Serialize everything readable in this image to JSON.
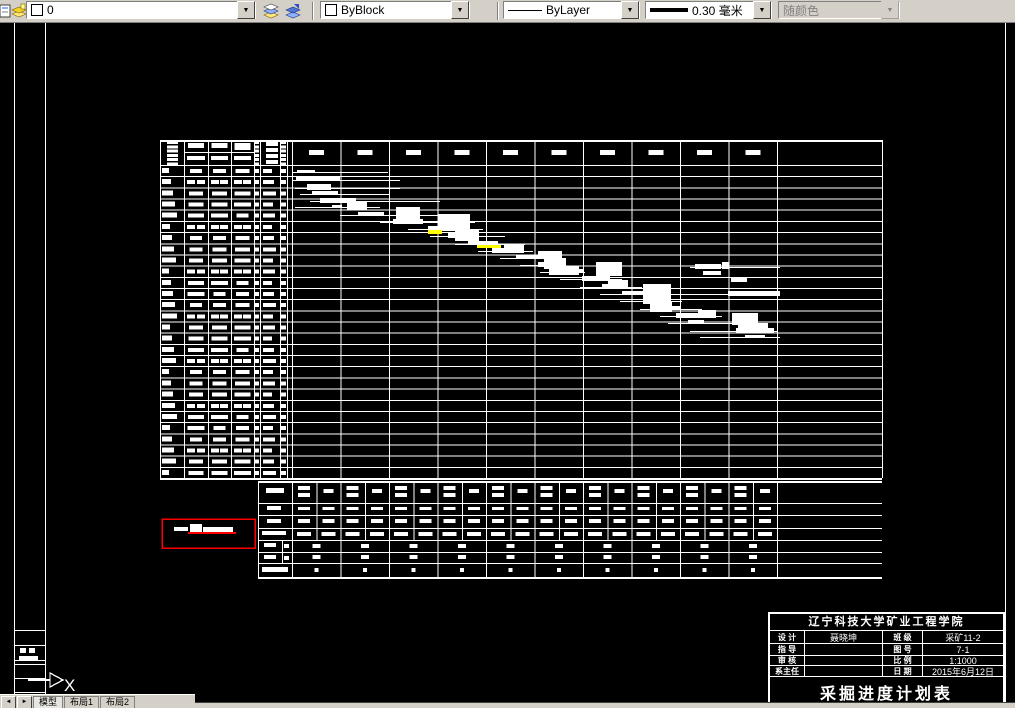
{
  "toolbar": {
    "layer": {
      "name": "0"
    },
    "color": {
      "value": "ByBlock"
    },
    "linetype": {
      "value": "ByLayer"
    },
    "lineweight": {
      "value": "0.30 毫米"
    },
    "plot_style": {
      "value": "随颜色"
    },
    "dropdown_arrow": "▼"
  },
  "tabs": {
    "nav_prev": "◄",
    "nav_next": "►",
    "items": [
      "模型",
      "布局1",
      "布局2"
    ]
  },
  "title_block": {
    "school": "辽宁科技大学矿业工程学院",
    "rows": [
      {
        "l1": "设 计",
        "v1": "聂晓坤",
        "l2": "班 级",
        "v2": "采矿11-2"
      },
      {
        "l1": "指 导",
        "v1": "",
        "l2": "图 号",
        "v2": "7-1"
      },
      {
        "l1": "审 核",
        "v1": "",
        "l2": "比 例",
        "v2": "1:1000"
      },
      {
        "l1": "系主任",
        "v1": "",
        "l2": "日 期",
        "v2": "2015年6月12日"
      }
    ],
    "title": "采掘进度计划表"
  },
  "ucs": {
    "label": "X"
  },
  "colors": {
    "white": "#ffffff",
    "yellow": "#ffff00",
    "red": "#ff0000",
    "toolbar_bg": "#d4d0c8"
  },
  "drawing": {
    "frame_vlines": [
      [
        14,
        22,
        703
      ],
      [
        45,
        22,
        703
      ],
      [
        1005,
        22,
        703
      ]
    ],
    "mini": {
      "x": 14,
      "w": 31,
      "hlines_y": [
        630,
        645,
        660,
        664,
        678,
        692
      ],
      "marks": [
        [
          20,
          648,
          6,
          5
        ],
        [
          29,
          648,
          6,
          5
        ],
        [
          19,
          656,
          19,
          5
        ]
      ]
    },
    "ucs_gfx": {
      "line": [
        28,
        679,
        50
      ],
      "arrow": "50,673 63,680 50,687"
    },
    "main": {
      "left": 160,
      "right": 882,
      "top": 140,
      "hdr": 165,
      "bottom": 478,
      "rows": 28,
      "rowH": 11.18,
      "cols": [
        160,
        184,
        208,
        231,
        254,
        260,
        280,
        287
      ],
      "gx": 292,
      "gw": 48.5,
      "gcols": 10,
      "hdrDash": [
        17,
        150,
        15,
        5
      ]
    },
    "sum": {
      "left": 258,
      "labelX": 292,
      "subX": 282,
      "top": 481,
      "bottom": 577,
      "right": 882,
      "halfW": 24.25,
      "halfCols": 20,
      "months": 10,
      "monthW": 48.5,
      "rowYs": [
        503,
        515,
        528,
        540,
        552,
        563
      ],
      "monthTop": 540
    },
    "bars": [
      [
        297,
        170,
        18,
        3
      ],
      [
        292,
        172,
        96,
        1
      ],
      [
        296,
        177,
        44,
        4
      ],
      [
        292,
        180,
        108,
        1
      ],
      [
        307,
        184,
        24,
        6
      ],
      [
        295,
        188,
        105,
        1
      ],
      [
        312,
        191,
        26,
        4
      ],
      [
        300,
        194,
        90,
        1
      ],
      [
        320,
        198,
        36,
        5
      ],
      [
        310,
        201,
        130,
        1
      ],
      [
        332,
        205,
        10,
        3
      ],
      [
        347,
        201,
        20,
        9
      ],
      [
        295,
        207,
        85,
        1
      ],
      [
        358,
        212,
        26,
        4
      ],
      [
        396,
        207,
        24,
        16
      ],
      [
        340,
        215,
        120,
        1
      ],
      [
        393,
        219,
        30,
        5
      ],
      [
        438,
        214,
        32,
        17
      ],
      [
        380,
        222,
        95,
        1
      ],
      [
        428,
        226,
        24,
        4
      ],
      [
        408,
        229,
        75,
        1
      ],
      [
        448,
        233,
        28,
        5
      ],
      [
        455,
        229,
        24,
        12
      ],
      [
        430,
        236,
        75,
        1
      ],
      [
        468,
        241,
        30,
        4
      ],
      [
        455,
        244,
        70,
        1
      ],
      [
        492,
        248,
        28,
        5
      ],
      [
        504,
        244,
        20,
        9
      ],
      [
        478,
        251,
        55,
        1
      ],
      [
        516,
        255,
        26,
        4
      ],
      [
        538,
        251,
        24,
        8
      ],
      [
        500,
        258,
        50,
        1
      ],
      [
        538,
        262,
        28,
        5
      ],
      [
        544,
        258,
        22,
        11
      ],
      [
        520,
        265,
        45,
        1
      ],
      [
        695,
        264,
        26,
        5
      ],
      [
        722,
        262,
        7,
        7
      ],
      [
        690,
        267,
        90,
        1
      ],
      [
        558,
        269,
        26,
        4
      ],
      [
        549,
        266,
        30,
        9
      ],
      [
        540,
        272,
        45,
        1
      ],
      [
        703,
        271,
        18,
        4
      ],
      [
        582,
        276,
        28,
        5
      ],
      [
        596,
        262,
        26,
        14
      ],
      [
        560,
        279,
        62,
        1
      ],
      [
        731,
        278,
        16,
        4
      ],
      [
        602,
        284,
        26,
        4
      ],
      [
        608,
        280,
        20,
        9
      ],
      [
        580,
        287,
        62,
        1
      ],
      [
        622,
        291,
        24,
        4
      ],
      [
        728,
        291,
        52,
        5
      ],
      [
        600,
        294,
        180,
        1
      ],
      [
        645,
        298,
        24,
        5
      ],
      [
        643,
        284,
        28,
        20
      ],
      [
        620,
        301,
        62,
        1
      ],
      [
        658,
        306,
        22,
        4
      ],
      [
        650,
        301,
        22,
        11
      ],
      [
        640,
        309,
        62,
        1
      ],
      [
        676,
        313,
        30,
        5
      ],
      [
        698,
        310,
        18,
        8
      ],
      [
        660,
        316,
        62,
        1
      ],
      [
        688,
        320,
        16,
        4
      ],
      [
        732,
        313,
        26,
        12
      ],
      [
        668,
        323,
        75,
        1
      ],
      [
        736,
        328,
        38,
        5
      ],
      [
        738,
        323,
        30,
        9
      ],
      [
        690,
        331,
        88,
        1
      ],
      [
        745,
        335,
        20,
        3
      ],
      [
        700,
        337,
        80,
        1
      ]
    ],
    "yellow": [
      [
        428,
        230,
        14,
        4
      ],
      [
        477,
        245,
        24,
        3
      ]
    ],
    "legend": {
      "box": [
        162,
        519,
        93,
        29
      ],
      "marks": [
        [
          174,
          527,
          14,
          4
        ],
        [
          190,
          524,
          12,
          9
        ],
        [
          203,
          527,
          30,
          5
        ]
      ],
      "red_line": [
        188,
        532,
        48,
        2
      ]
    }
  }
}
